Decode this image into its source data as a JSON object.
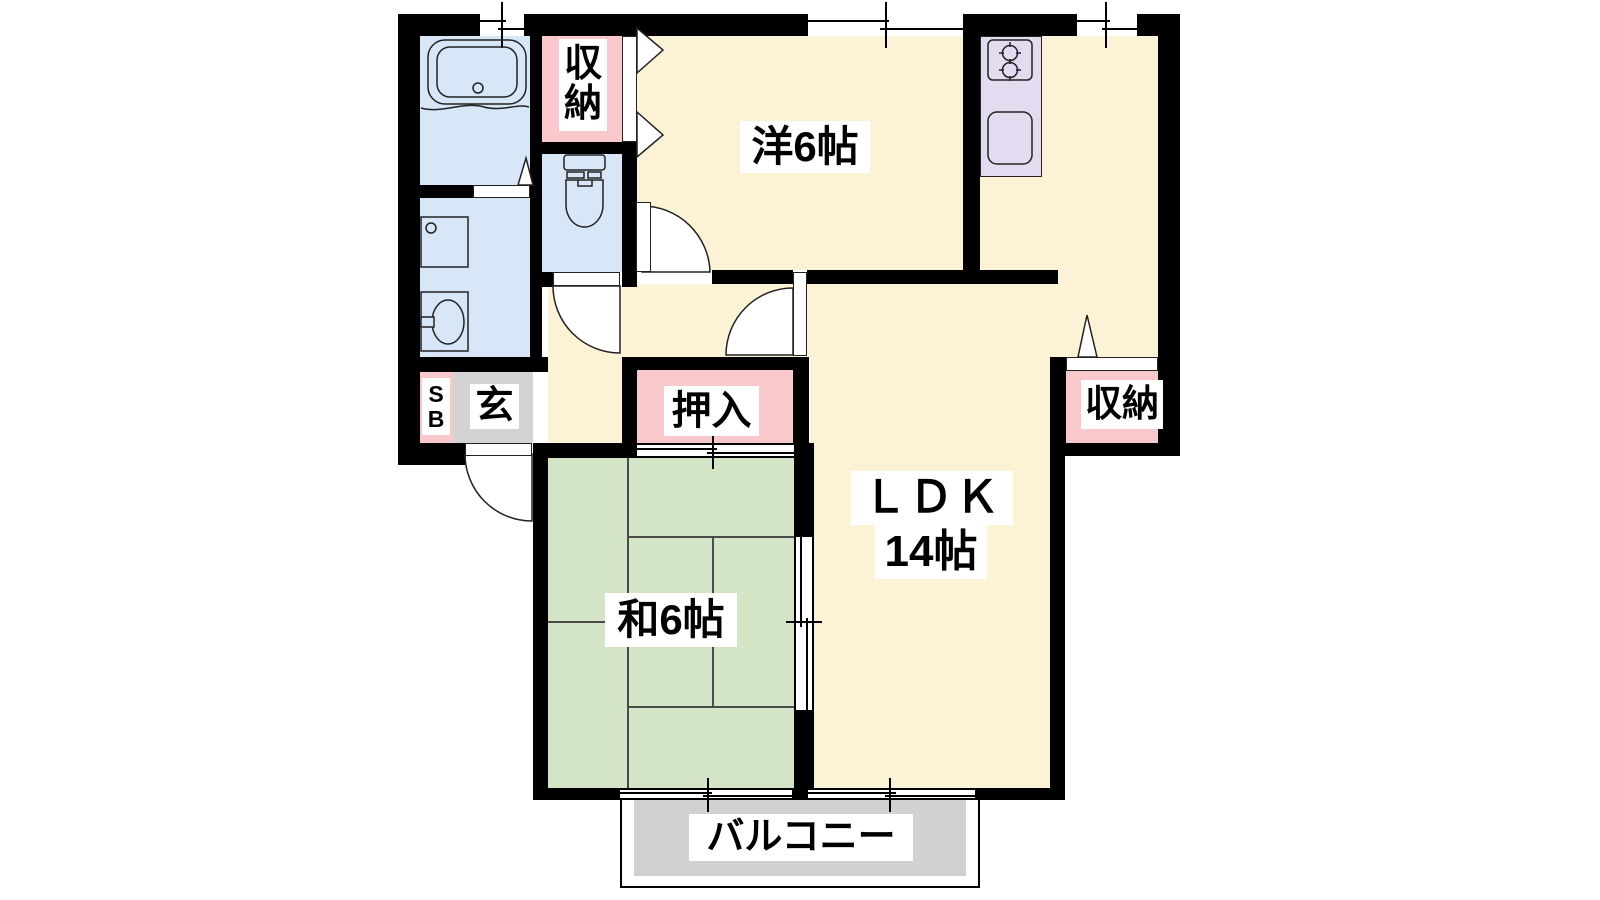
{
  "plan": {
    "title": "2LDK apartment floor plan",
    "rooms": {
      "western_room": {
        "label": "洋6帖"
      },
      "ldk": {
        "label": "ＬＤＫ",
        "size_label": "14帖"
      },
      "japanese_room": {
        "label": "和6帖"
      },
      "closet_top": {
        "label_chars": [
          "収",
          "納"
        ]
      },
      "closet_right": {
        "label": "収納"
      },
      "futon_closet": {
        "label": "押入"
      },
      "entrance": {
        "label": "玄"
      },
      "shoe_box": {
        "label_chars": [
          "S",
          "B"
        ]
      },
      "balcony": {
        "label": "バルコニー"
      }
    },
    "fixtures": [
      "bathtub",
      "washing-machine",
      "washbasin",
      "toilet",
      "gas-stove",
      "kitchen-sink"
    ],
    "colors": {
      "wall": "#000000",
      "room_floor": "#fcf2d5",
      "tatami_floor": "#d3e4c7",
      "wet_area_floor": "#d8e7f7",
      "storage_fill": "#f9c8ca",
      "kitchen_counter": "#e3dbef",
      "entrance_floor": "#d3d3d3",
      "balcony_floor": "#d1d1d1",
      "label_bg": "#ffffff",
      "label_text": "#000000"
    }
  }
}
